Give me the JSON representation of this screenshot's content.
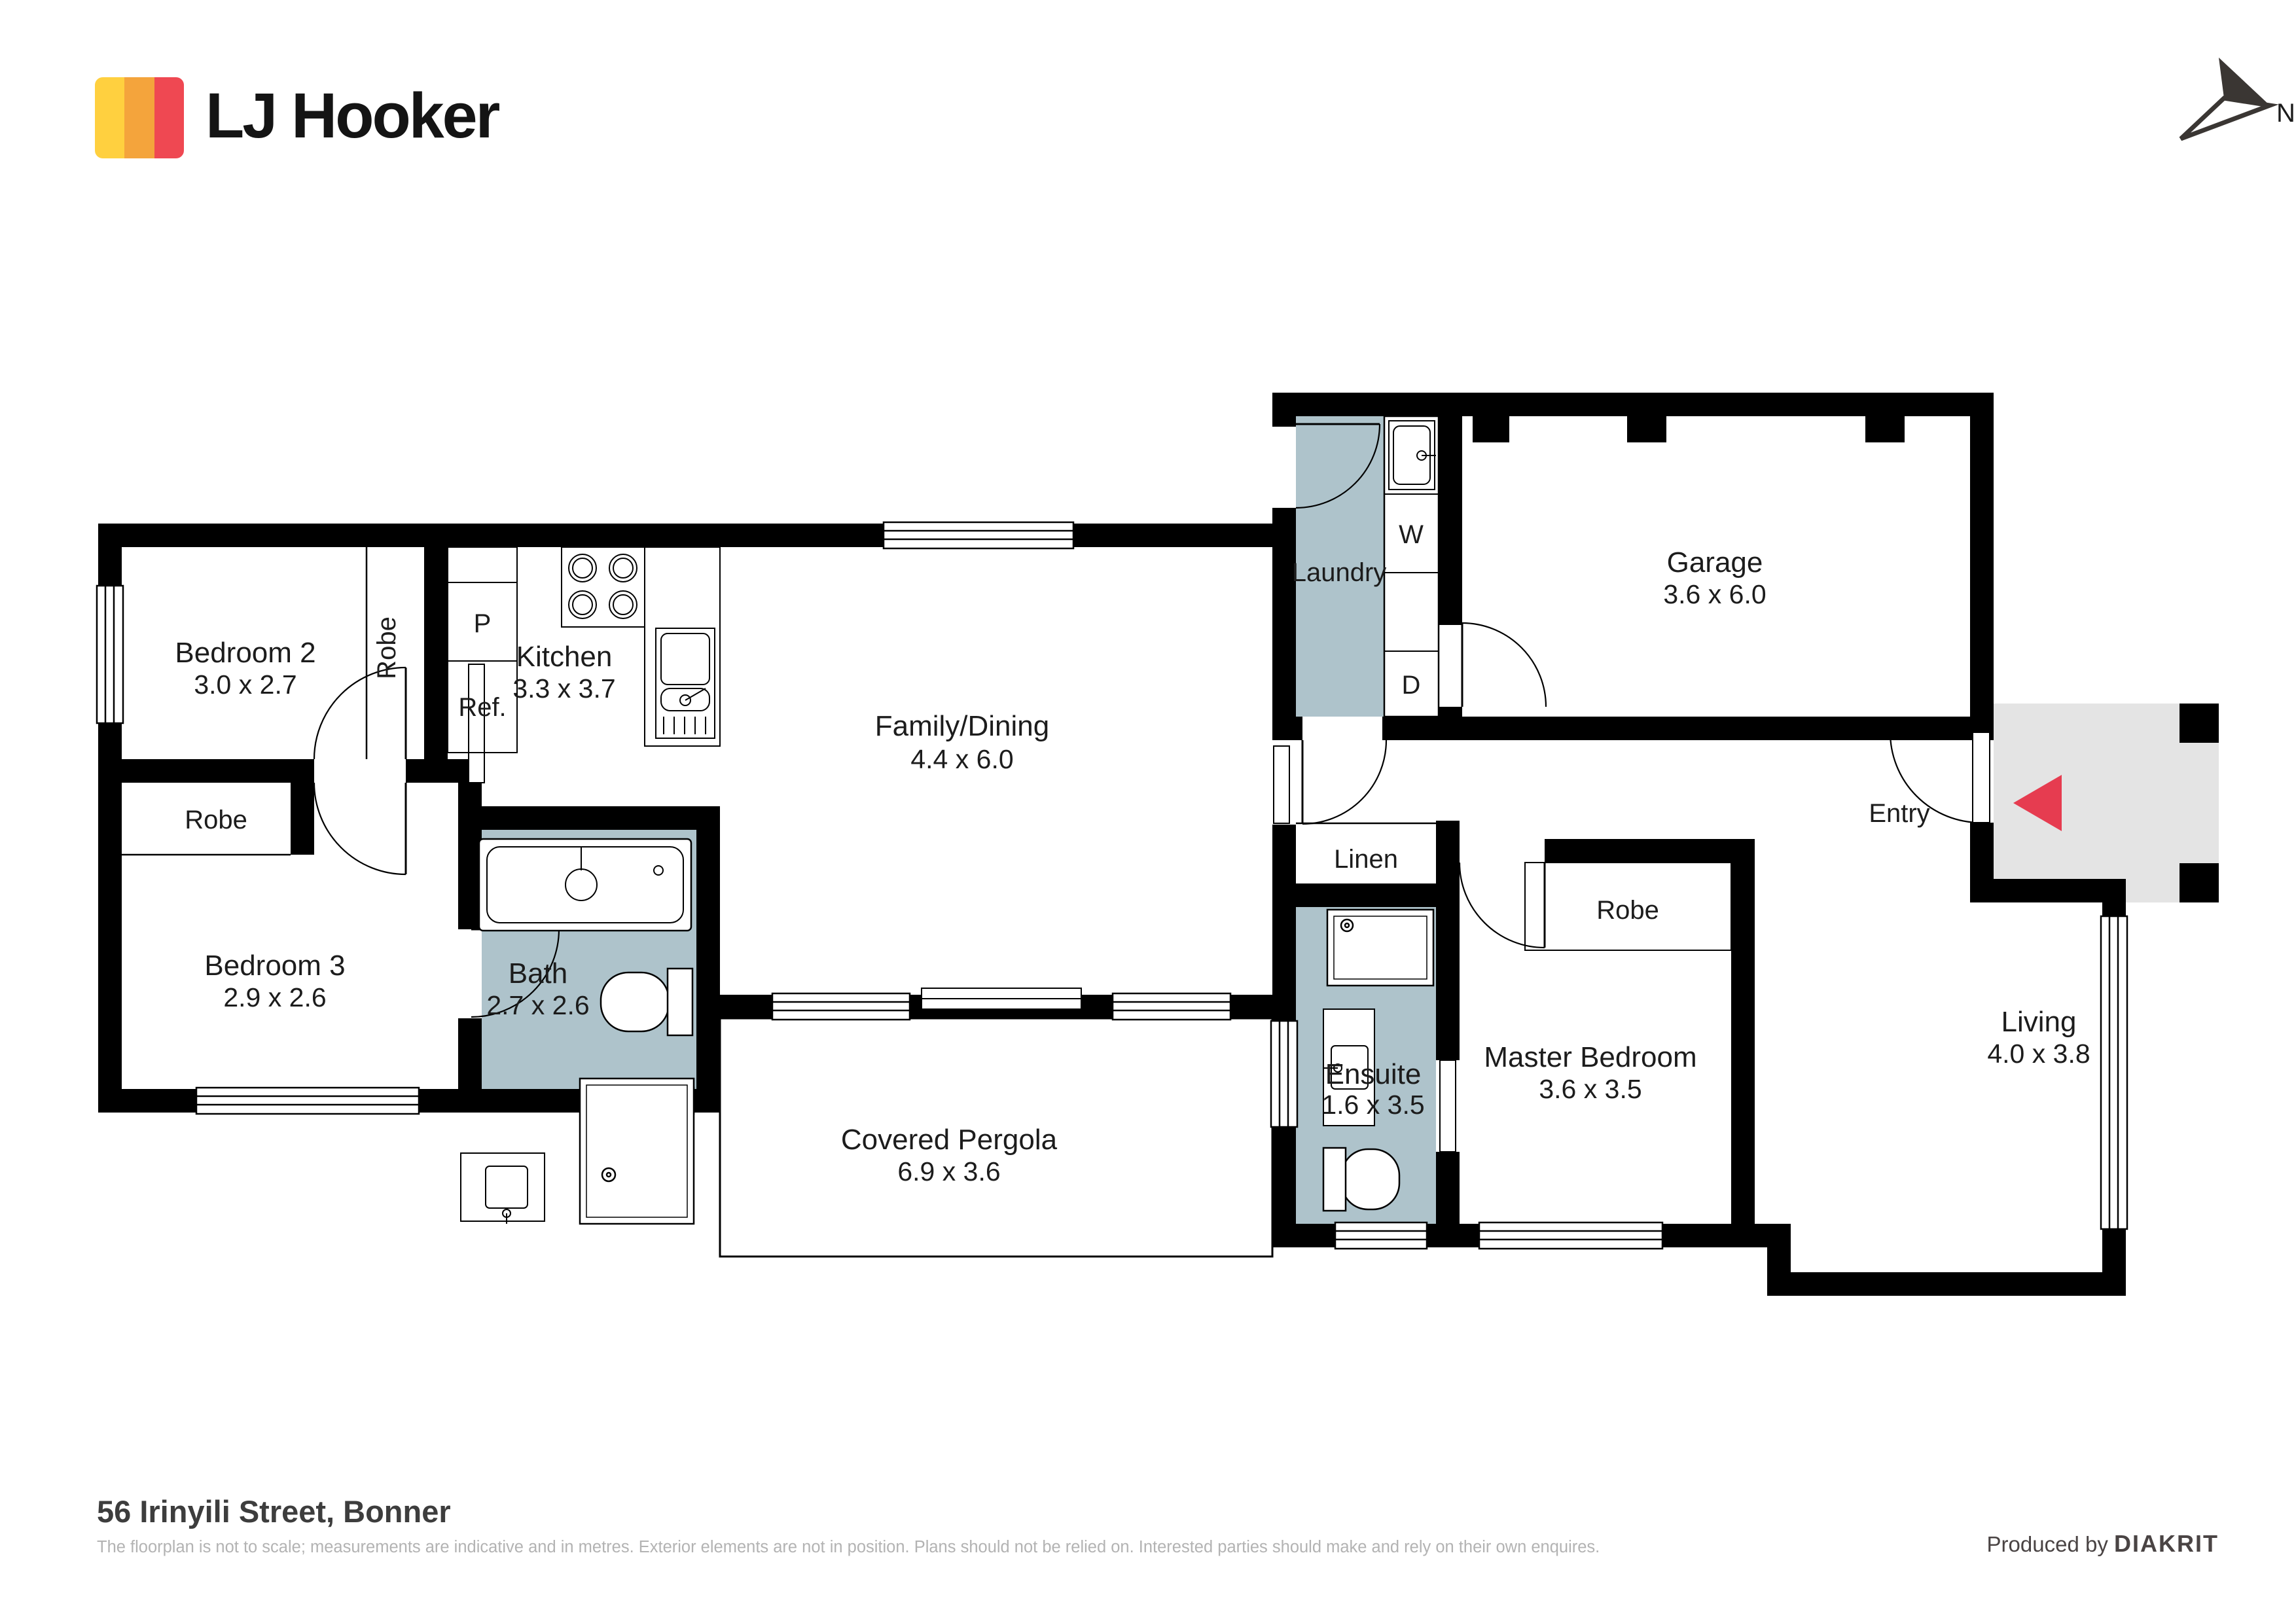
{
  "brand": {
    "name": "LJ Hooker"
  },
  "compass": {
    "north_label": "N"
  },
  "plan": {
    "bedroom2": {
      "name": "Bedroom 2",
      "dims": "3.0 x 2.7"
    },
    "bedroom3": {
      "name": "Bedroom 3",
      "dims": "2.9 x 2.6"
    },
    "kitchen": {
      "name": "Kitchen",
      "dims": "3.3 x 3.7"
    },
    "family": {
      "name": "Family/Dining",
      "dims": "4.4 x 6.0"
    },
    "laundry": {
      "name": "Laundry"
    },
    "garage": {
      "name": "Garage",
      "dims": "3.6 x 6.0"
    },
    "bath": {
      "name": "Bath",
      "dims": "2.7 x 2.6"
    },
    "pergola": {
      "name": "Covered Pergola",
      "dims": "6.9 x 3.6"
    },
    "ensuite": {
      "name": "Ensuite",
      "dims": "1.6 x 3.5"
    },
    "master": {
      "name": "Master Bedroom",
      "dims": "3.6 x 3.5"
    },
    "living": {
      "name": "Living",
      "dims": "4.0 x 3.8"
    },
    "entry": {
      "name": "Entry"
    },
    "linen": {
      "name": "Linen"
    },
    "robe_bedroom2": {
      "name": "Robe"
    },
    "robe_bedroom3": {
      "name": "Robe"
    },
    "robe_master": {
      "name": "Robe"
    },
    "appliances": {
      "washer": "W",
      "dryer": "D",
      "pantry": "P",
      "fridge": "Ref."
    },
    "fixtures": [
      "bathtub",
      "toilet",
      "shower",
      "vanity",
      "kitchen-sink",
      "stove",
      "laundry-tub"
    ]
  },
  "footer": {
    "address": "56 Irinyili Street, Bonner",
    "disclaimer": "The floorplan is not to scale; measurements are indicative and in metres. Exterior elements are not in position. Plans should not be relied on. Interested parties should make and rely on their own enquires.",
    "credit_prefix": "Produced by",
    "credit_brand": "DIAKRIT"
  },
  "colors": {
    "wall": "#000000",
    "wet_area": "#AEC3CB",
    "porch": "#E4E4E4",
    "arrow_red": "#E63C50",
    "logo_yellow": "#FFD03F",
    "logo_orange": "#F4A43C",
    "logo_red": "#EF4852"
  }
}
